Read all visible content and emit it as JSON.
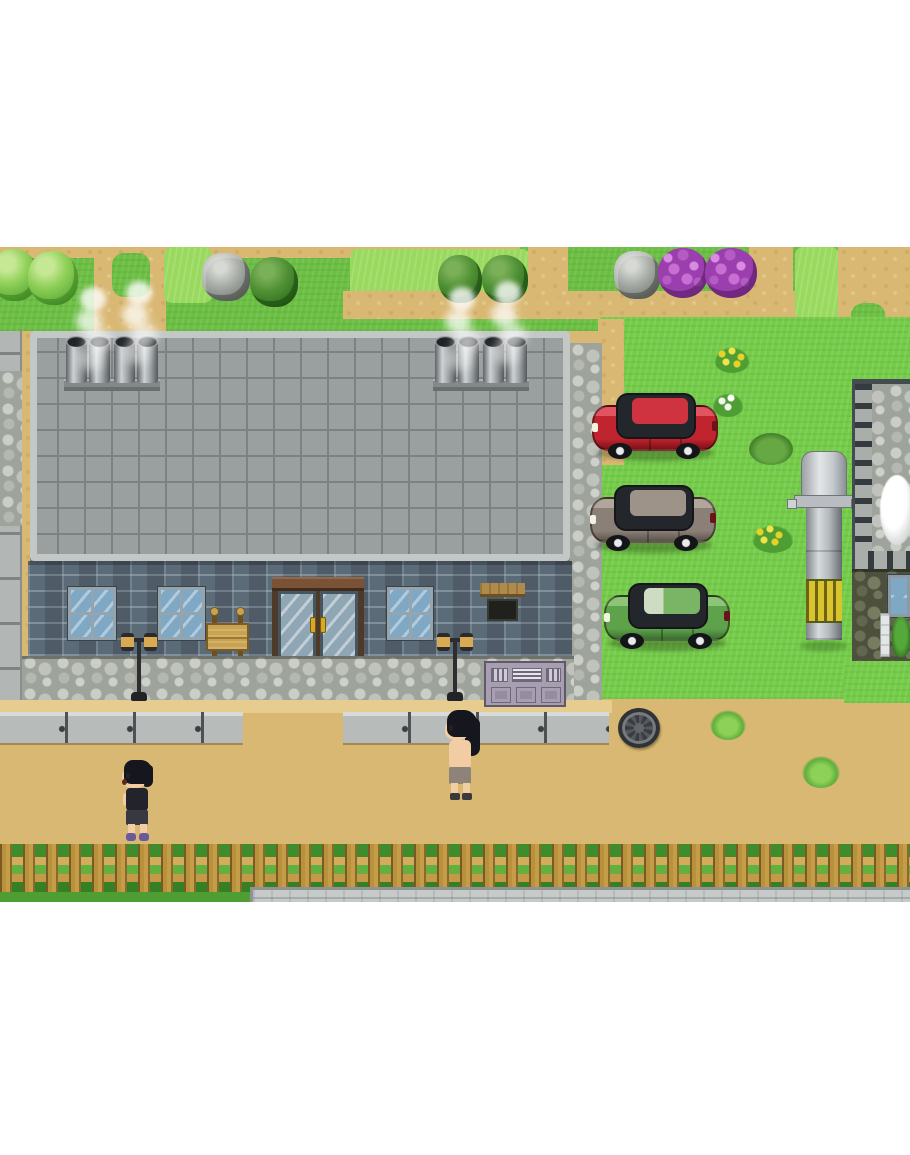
{
  "meta": {
    "description": "Top-down pixel-art RPG town scene, letterboxed on white",
    "visible_text": []
  },
  "palette": {
    "white": "#ffffff",
    "grass": "#6cbf44",
    "grass_bright": "#74cc49",
    "grass_light": "#9ad95f",
    "grass_dark": "#4f9e33",
    "sand": "#d9b873",
    "sand_light": "#e6cd8f",
    "roof": "#9aa0a0",
    "roof_line": "#7b8282",
    "roof_border": "#c3c7c5",
    "brick": "#5c6b78",
    "cobble_base": "#9ea39b",
    "sidewalk": "#b7bbb9",
    "fence_wood": "#c59d49",
    "car_red": "#c0242e",
    "car_gray": "#8b8077",
    "car_green": "#5ea24b",
    "silo_gray": "#b3b7bb",
    "silo_yellow": "#d9c42e",
    "skin": "#f2cda4",
    "hair": "#16161e",
    "glass": "#7fa8c4",
    "lamp_amber": "#d9aa52",
    "flower_purple": "#b55cc4",
    "rock_gray": "#a9ada7"
  },
  "scene": {
    "npcs": [
      {
        "id": "villager-left",
        "label": "Dark-haired villager in black tank top and purple shoes walking left on the dirt road"
      },
      {
        "id": "villager-center",
        "label": "Long-haired shirtless villager facing left at the sidewalk edge"
      }
    ],
    "vehicles": [
      {
        "id": "car-red",
        "label": "Red car parked on grass facing left",
        "color": "#c0242e"
      },
      {
        "id": "car-gray",
        "label": "Gray car parked on grass facing left",
        "color": "#8b8077"
      },
      {
        "id": "car-green",
        "label": "Green car parked on grass facing left",
        "color": "#5ea24b"
      }
    ],
    "buildings": [
      {
        "id": "main-hall",
        "label": "Large building with gray tiled roof, four smoking chimneys, brick wall, glass double door, three windows, wooden sign, two street lamps, vent unit"
      },
      {
        "id": "right-building",
        "label": "Stone-roofed building at right edge with dark cobble wall, window, drainpipe and plant"
      },
      {
        "id": "left-edge-wall",
        "label": "Concrete wall of neighboring structure at left edge"
      }
    ],
    "props": [
      {
        "id": "silo",
        "label": "Gray silo tower with dome top and yellow striped band"
      },
      {
        "id": "manhole",
        "label": "Round manhole cover on the dirt road"
      },
      {
        "id": "wooden-sign",
        "label": "Wooden notice board in front of the building"
      },
      {
        "id": "glass-door",
        "label": "Double glass entrance door with gold handles"
      },
      {
        "id": "picket-fence",
        "label": "Wooden picket fence along the bottom with grass behind"
      },
      {
        "id": "concrete-pad",
        "label": "Concrete pavement strip below the fence at right"
      },
      {
        "id": "trees",
        "label": "Round light and dark green trees in the top grass strip"
      },
      {
        "id": "rock-piles",
        "label": "Two gray rock piles in the top grass strip"
      },
      {
        "id": "purple-bushes",
        "label": "Two purple flowering bushes in the top grass strip"
      },
      {
        "id": "flowers",
        "label": "Yellow and white flower clusters on the parking grass and road"
      }
    ]
  }
}
